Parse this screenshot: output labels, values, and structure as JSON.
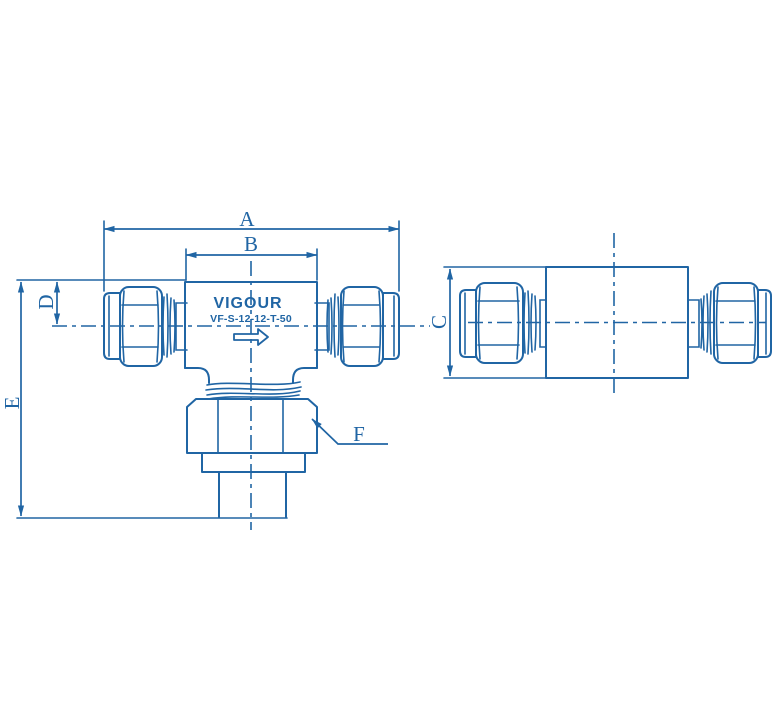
{
  "drawing": {
    "brand_label": "VIGOUR",
    "part_number": "VF-S-12-12-T-50",
    "dimension_labels": {
      "a": "A",
      "b": "B",
      "c": "C",
      "d": "D",
      "e": "E",
      "f": "F"
    },
    "colors": {
      "line_blue": "#2065a4",
      "background": "#ffffff",
      "logo_background": "#ffffff",
      "logo_text": "#2065a4"
    }
  }
}
